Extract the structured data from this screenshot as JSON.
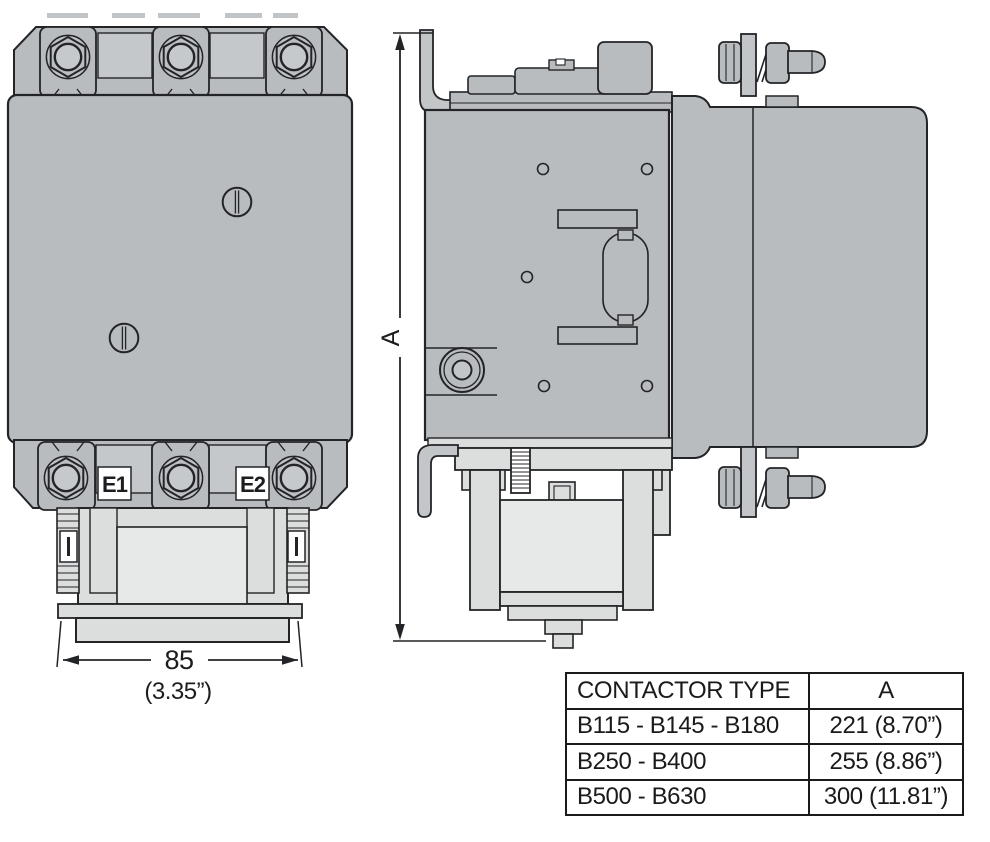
{
  "drawing": {
    "front_view": {
      "terminal_e1": "E1",
      "terminal_e2": "E2",
      "width_dim_mm": "85",
      "width_dim_in": "(3.35”)"
    },
    "side_view": {
      "height_dim_label": "A"
    }
  },
  "table": {
    "headers": {
      "type": "CONTACTOR TYPE",
      "a": "A"
    },
    "rows": [
      {
        "type": "B115 - B145 - B180",
        "a": "221 (8.70”)"
      },
      {
        "type": "B250 - B400",
        "a": "255 (8.86”)"
      },
      {
        "type": "B500 - B630",
        "a": "300 (11.81”)"
      }
    ]
  },
  "colors": {
    "body_gray": "#b9bcbe",
    "light_gray": "#dcdddd",
    "inner_light": "#e7e8e8",
    "line": "#232427",
    "background": "#ffffff"
  }
}
